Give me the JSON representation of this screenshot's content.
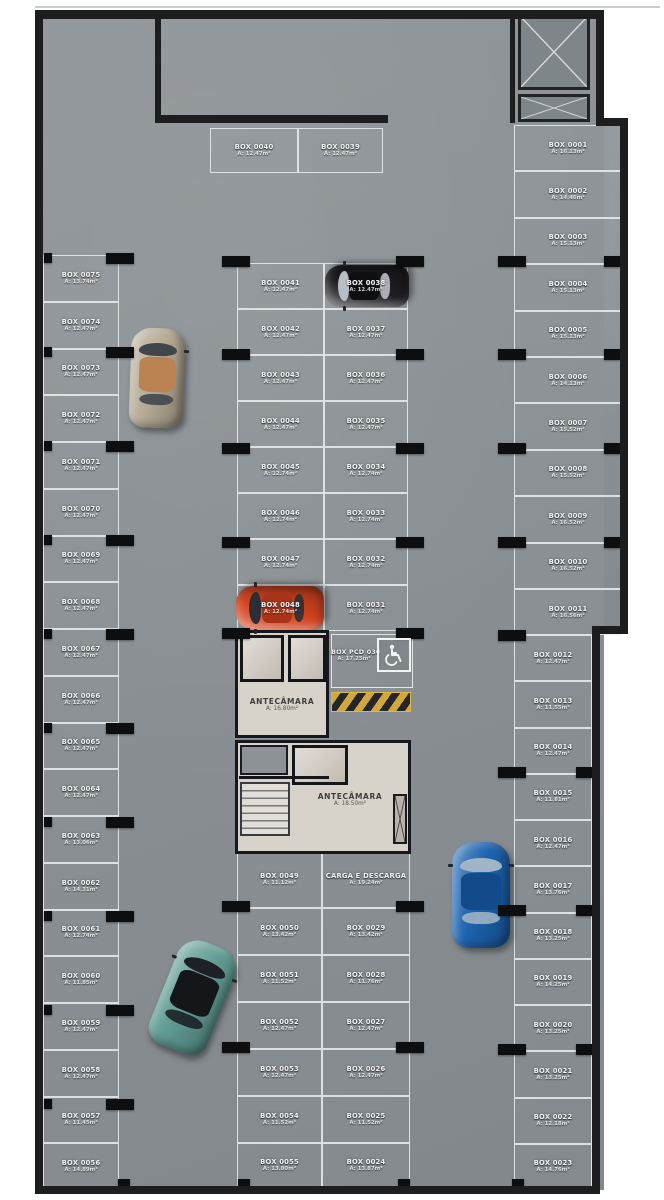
{
  "plan_name": "parking-level-floor-plan",
  "colors": {
    "floor": "#8a9094",
    "wall": "#1b1d1f",
    "stripe_line": "#eef0f0",
    "hazard_yellow": "#d0a83e",
    "room_floor": "#d8d3ca",
    "background": "#ffffff"
  },
  "stalls": {
    "left_column": [
      {
        "label": "BOX 0075",
        "area": "A: 13.74m²"
      },
      {
        "label": "BOX 0074",
        "area": "A: 12.47m²"
      },
      {
        "label": "BOX 0073",
        "area": "A: 12.47m²"
      },
      {
        "label": "BOX 0072",
        "area": "A: 12.47m²"
      },
      {
        "label": "BOX 0071",
        "area": "A: 12.47m²"
      },
      {
        "label": "BOX 0070",
        "area": "A: 12.47m²"
      },
      {
        "label": "BOX 0069",
        "area": "A: 12.47m²"
      },
      {
        "label": "BOX 0068",
        "area": "A: 12.47m²"
      },
      {
        "label": "BOX 0067",
        "area": "A: 12.47m²"
      },
      {
        "label": "BOX 0066",
        "area": "A: 12.47m²"
      },
      {
        "label": "BOX 0065",
        "area": "A: 12.47m²"
      },
      {
        "label": "BOX 0064",
        "area": "A: 12.47m²"
      },
      {
        "label": "BOX 0063",
        "area": "A: 13.06m²"
      },
      {
        "label": "BOX 0062",
        "area": "A: 14.31m²"
      },
      {
        "label": "BOX 0061",
        "area": "A: 12.74m²"
      },
      {
        "label": "BOX 0060",
        "area": "A: 11.85m²"
      },
      {
        "label": "BOX 0059",
        "area": "A: 12.47m²"
      },
      {
        "label": "BOX 0058",
        "area": "A: 12.47m²"
      },
      {
        "label": "BOX 0057",
        "area": "A: 11.45m²"
      },
      {
        "label": "BOX 0056",
        "area": "A: 14.89m²"
      }
    ],
    "right_top": [
      {
        "label": "BOX 0001",
        "area": "A: 16.13m²"
      },
      {
        "label": "BOX 0002",
        "area": "A: 14.46m²"
      },
      {
        "label": "BOX 0003",
        "area": "A: 15.13m²"
      },
      {
        "label": "BOX 0004",
        "area": "A: 15.13m²"
      },
      {
        "label": "BOX 0005",
        "area": "A: 15.13m²"
      },
      {
        "label": "BOX 0006",
        "area": "A: 14.13m²"
      },
      {
        "label": "BOX 0007",
        "area": "A: 15.52m²"
      },
      {
        "label": "BOX 0008",
        "area": "A: 15.52m²"
      },
      {
        "label": "BOX 0009",
        "area": "A: 16.52m²"
      },
      {
        "label": "BOX 0010",
        "area": "A: 16.52m²"
      },
      {
        "label": "BOX 0011",
        "area": "A: 16.56m²"
      }
    ],
    "right_bottom": [
      {
        "label": "BOX 0012",
        "area": "A: 12.47m²"
      },
      {
        "label": "BOX 0013",
        "area": "A: 11.55m²"
      },
      {
        "label": "BOX 0014",
        "area": "A: 12.47m²"
      },
      {
        "label": "BOX 0015",
        "area": "A: 11.81m²"
      },
      {
        "label": "BOX 0016",
        "area": "A: 12.47m²"
      },
      {
        "label": "BOX 0017",
        "area": "A: 13.76m²"
      },
      {
        "label": "BOX 0018",
        "area": "A: 13.25m²"
      },
      {
        "label": "BOX 0019",
        "area": "A: 14.25m²"
      },
      {
        "label": "BOX 0020",
        "area": "A: 13.25m²"
      },
      {
        "label": "BOX 0021",
        "area": "A: 13.25m²"
      },
      {
        "label": "BOX 0022",
        "area": "A: 12.18m²"
      },
      {
        "label": "BOX 0023",
        "area": "A: 14.76m²"
      }
    ],
    "top_row": [
      {
        "label": "BOX 0040",
        "area": "A: 12.47m²"
      },
      {
        "label": "BOX 0039",
        "area": "A: 12.47m²"
      }
    ],
    "center_left": [
      {
        "label": "BOX 0041",
        "area": "A: 12.47m²"
      },
      {
        "label": "BOX 0042",
        "area": "A: 12.47m²"
      },
      {
        "label": "BOX 0043",
        "area": "A: 12.47m²"
      },
      {
        "label": "BOX 0044",
        "area": "A: 12.47m²"
      },
      {
        "label": "BOX 0045",
        "area": "A: 12.74m²"
      },
      {
        "label": "BOX 0046",
        "area": "A: 12.74m²"
      },
      {
        "label": "BOX 0047",
        "area": "A: 12.74m²"
      },
      {
        "label": "BOX 0048",
        "area": "A: 12.74m²"
      }
    ],
    "center_right": [
      {
        "label": "BOX 0038",
        "area": "A: 12.47m²"
      },
      {
        "label": "BOX 0037",
        "area": "A: 12.47m²"
      },
      {
        "label": "BOX 0036",
        "area": "A: 12.47m²"
      },
      {
        "label": "BOX 0035",
        "area": "A: 12.47m²"
      },
      {
        "label": "BOX 0034",
        "area": "A: 12.74m²"
      },
      {
        "label": "BOX 0033",
        "area": "A: 12.74m²"
      },
      {
        "label": "BOX 0032",
        "area": "A: 12.74m²"
      },
      {
        "label": "BOX 0031",
        "area": "A: 12.74m²"
      }
    ],
    "bottom_left": [
      {
        "label": "BOX 0049",
        "area": "A: 11.12m²"
      },
      {
        "label": "BOX 0050",
        "area": "A: 13.42m²"
      },
      {
        "label": "BOX 0051",
        "area": "A: 11.52m²"
      },
      {
        "label": "BOX 0052",
        "area": "A: 12.47m²"
      },
      {
        "label": "BOX 0053",
        "area": "A: 12.47m²"
      },
      {
        "label": "BOX 0054",
        "area": "A: 11.52m²"
      },
      {
        "label": "BOX 0055",
        "area": "A: 13.80m²"
      }
    ],
    "bottom_right": [
      {
        "label": "CARGA E DESCARGA",
        "area": "A: 19.24m²"
      },
      {
        "label": "BOX 0029",
        "area": "A: 13.42m²"
      },
      {
        "label": "BOX 0028",
        "area": "A: 11.76m²"
      },
      {
        "label": "BOX 0027",
        "area": "A: 12.47m²"
      },
      {
        "label": "BOX 0026",
        "area": "A: 12.47m²"
      },
      {
        "label": "BOX 0025",
        "area": "A: 11.52m²"
      },
      {
        "label": "BOX 0024",
        "area": "A: 13.87m²"
      }
    ]
  },
  "rooms": {
    "antechamber_upper": {
      "label": "ANTECÂMARA",
      "area": "A: 16.80m²"
    },
    "antechamber_lower": {
      "label": "ANTECÂMARA",
      "area": "A: 18.50m²"
    },
    "pcd_stall": {
      "label": "BOX PCD 030",
      "area": "A: 17.25m²"
    }
  },
  "icons": [
    {
      "name": "wheelchair-accessibility-icon"
    },
    {
      "name": "cross-braced-shaft-icon"
    },
    {
      "name": "stairs-icon"
    }
  ],
  "cars": [
    {
      "name": "beige-convertible-car",
      "body": "#b6ac97",
      "top": "#bb8252",
      "glass": "#41464d"
    },
    {
      "name": "black-car",
      "body": "#1d1d22",
      "top": "#0f0f13",
      "glass": "#b9bec4"
    },
    {
      "name": "red-car",
      "body": "#d2431f",
      "top": "#a93317",
      "glass": "#2a2f36"
    },
    {
      "name": "blue-car",
      "body": "#1c63b0",
      "top": "#134b8a",
      "glass": "#9fb4c4"
    },
    {
      "name": "teal-car",
      "body": "#619e95",
      "top": "#15161a",
      "glass": "#1d2025"
    }
  ]
}
